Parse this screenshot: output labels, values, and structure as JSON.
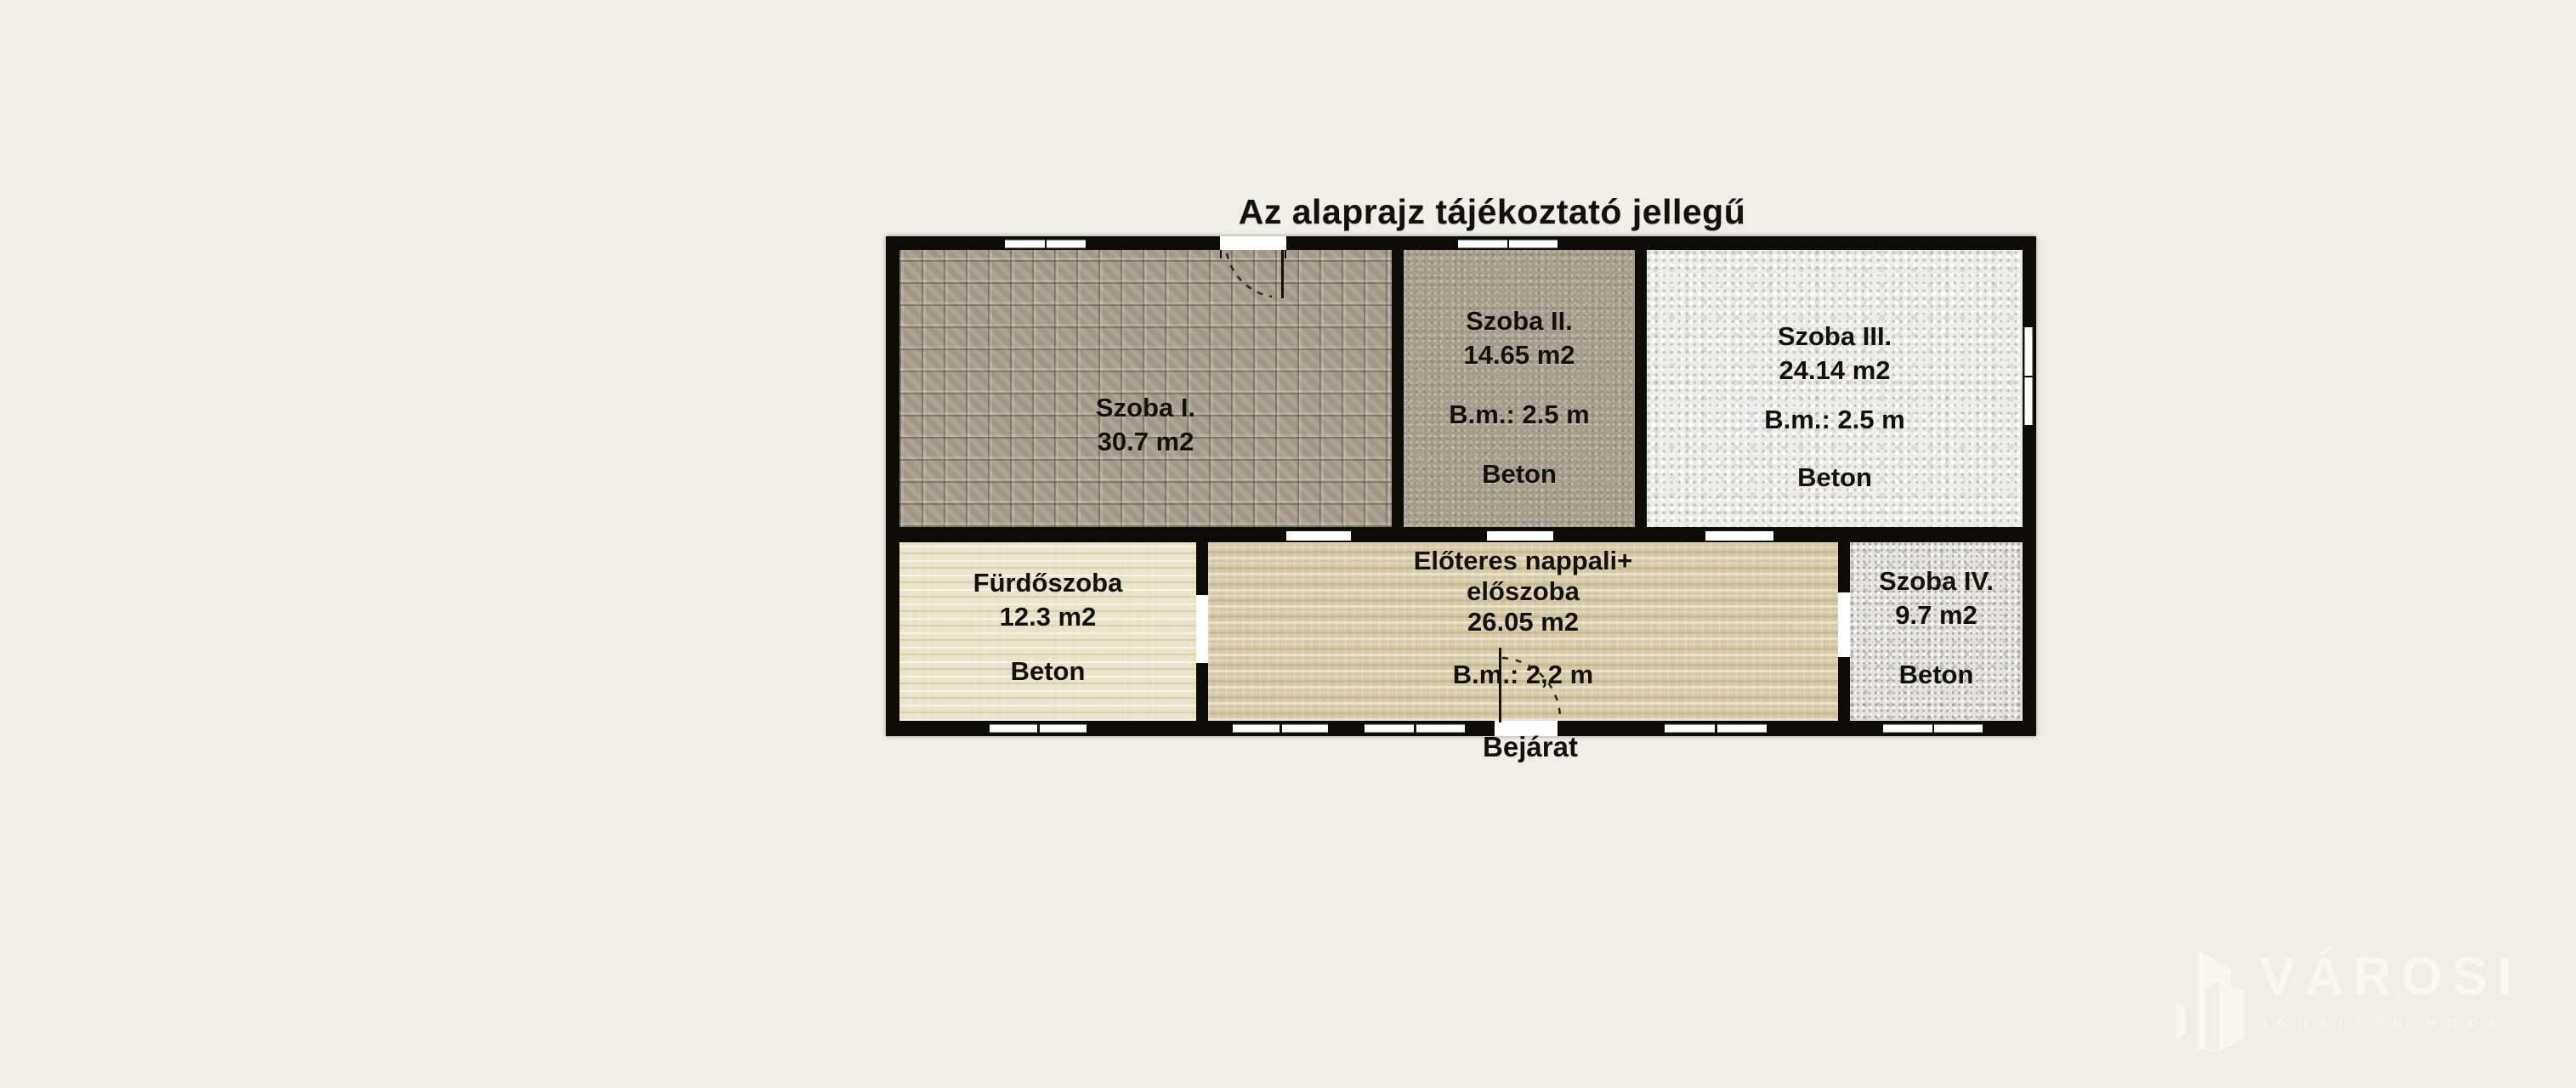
{
  "title": "Az alaprajz tájékoztató jellegű",
  "entrance": {
    "label": "Bejárat"
  },
  "rooms": {
    "szoba1": {
      "name": "Szoba I.",
      "area": "30.7 m2"
    },
    "szoba2": {
      "name": "Szoba II.",
      "area": "14.65 m2",
      "ceiling": "B.m.: 2.5 m",
      "floor": "Beton"
    },
    "szoba3": {
      "name": "Szoba III.",
      "area": "24.14 m2",
      "ceiling": "B.m.: 2.5 m",
      "floor": "Beton"
    },
    "furdoszoba": {
      "name": "Fürdőszoba",
      "area": "12.3 m2",
      "floor": "Beton"
    },
    "eloter": {
      "name_line1": "Előteres nappali+",
      "name_line2": "előszoba",
      "area": "26.05 m2",
      "ceiling": "B.m.: 2,2 m"
    },
    "szoba4": {
      "name": "Szoba IV.",
      "area": "9.7 m2",
      "floor": "Beton"
    }
  },
  "logo": {
    "brand": "VÁROSI",
    "subtitle": "INGATLANIRODA"
  },
  "colors": {
    "background": "#f0eee9",
    "wall": "#0d0b08",
    "window_fill": "#ffffff",
    "label_text": "#14110b",
    "szoba1_floor": "#a89e8e",
    "szoba2_floor": "#a79d8d",
    "szoba3_floor": "#ececea",
    "furdoszoba_floor": "#ebe3c9",
    "eloter_floor": "#d5c9a5",
    "szoba4_floor": "#e3e2de",
    "logo_color": "#f9f7f2"
  }
}
